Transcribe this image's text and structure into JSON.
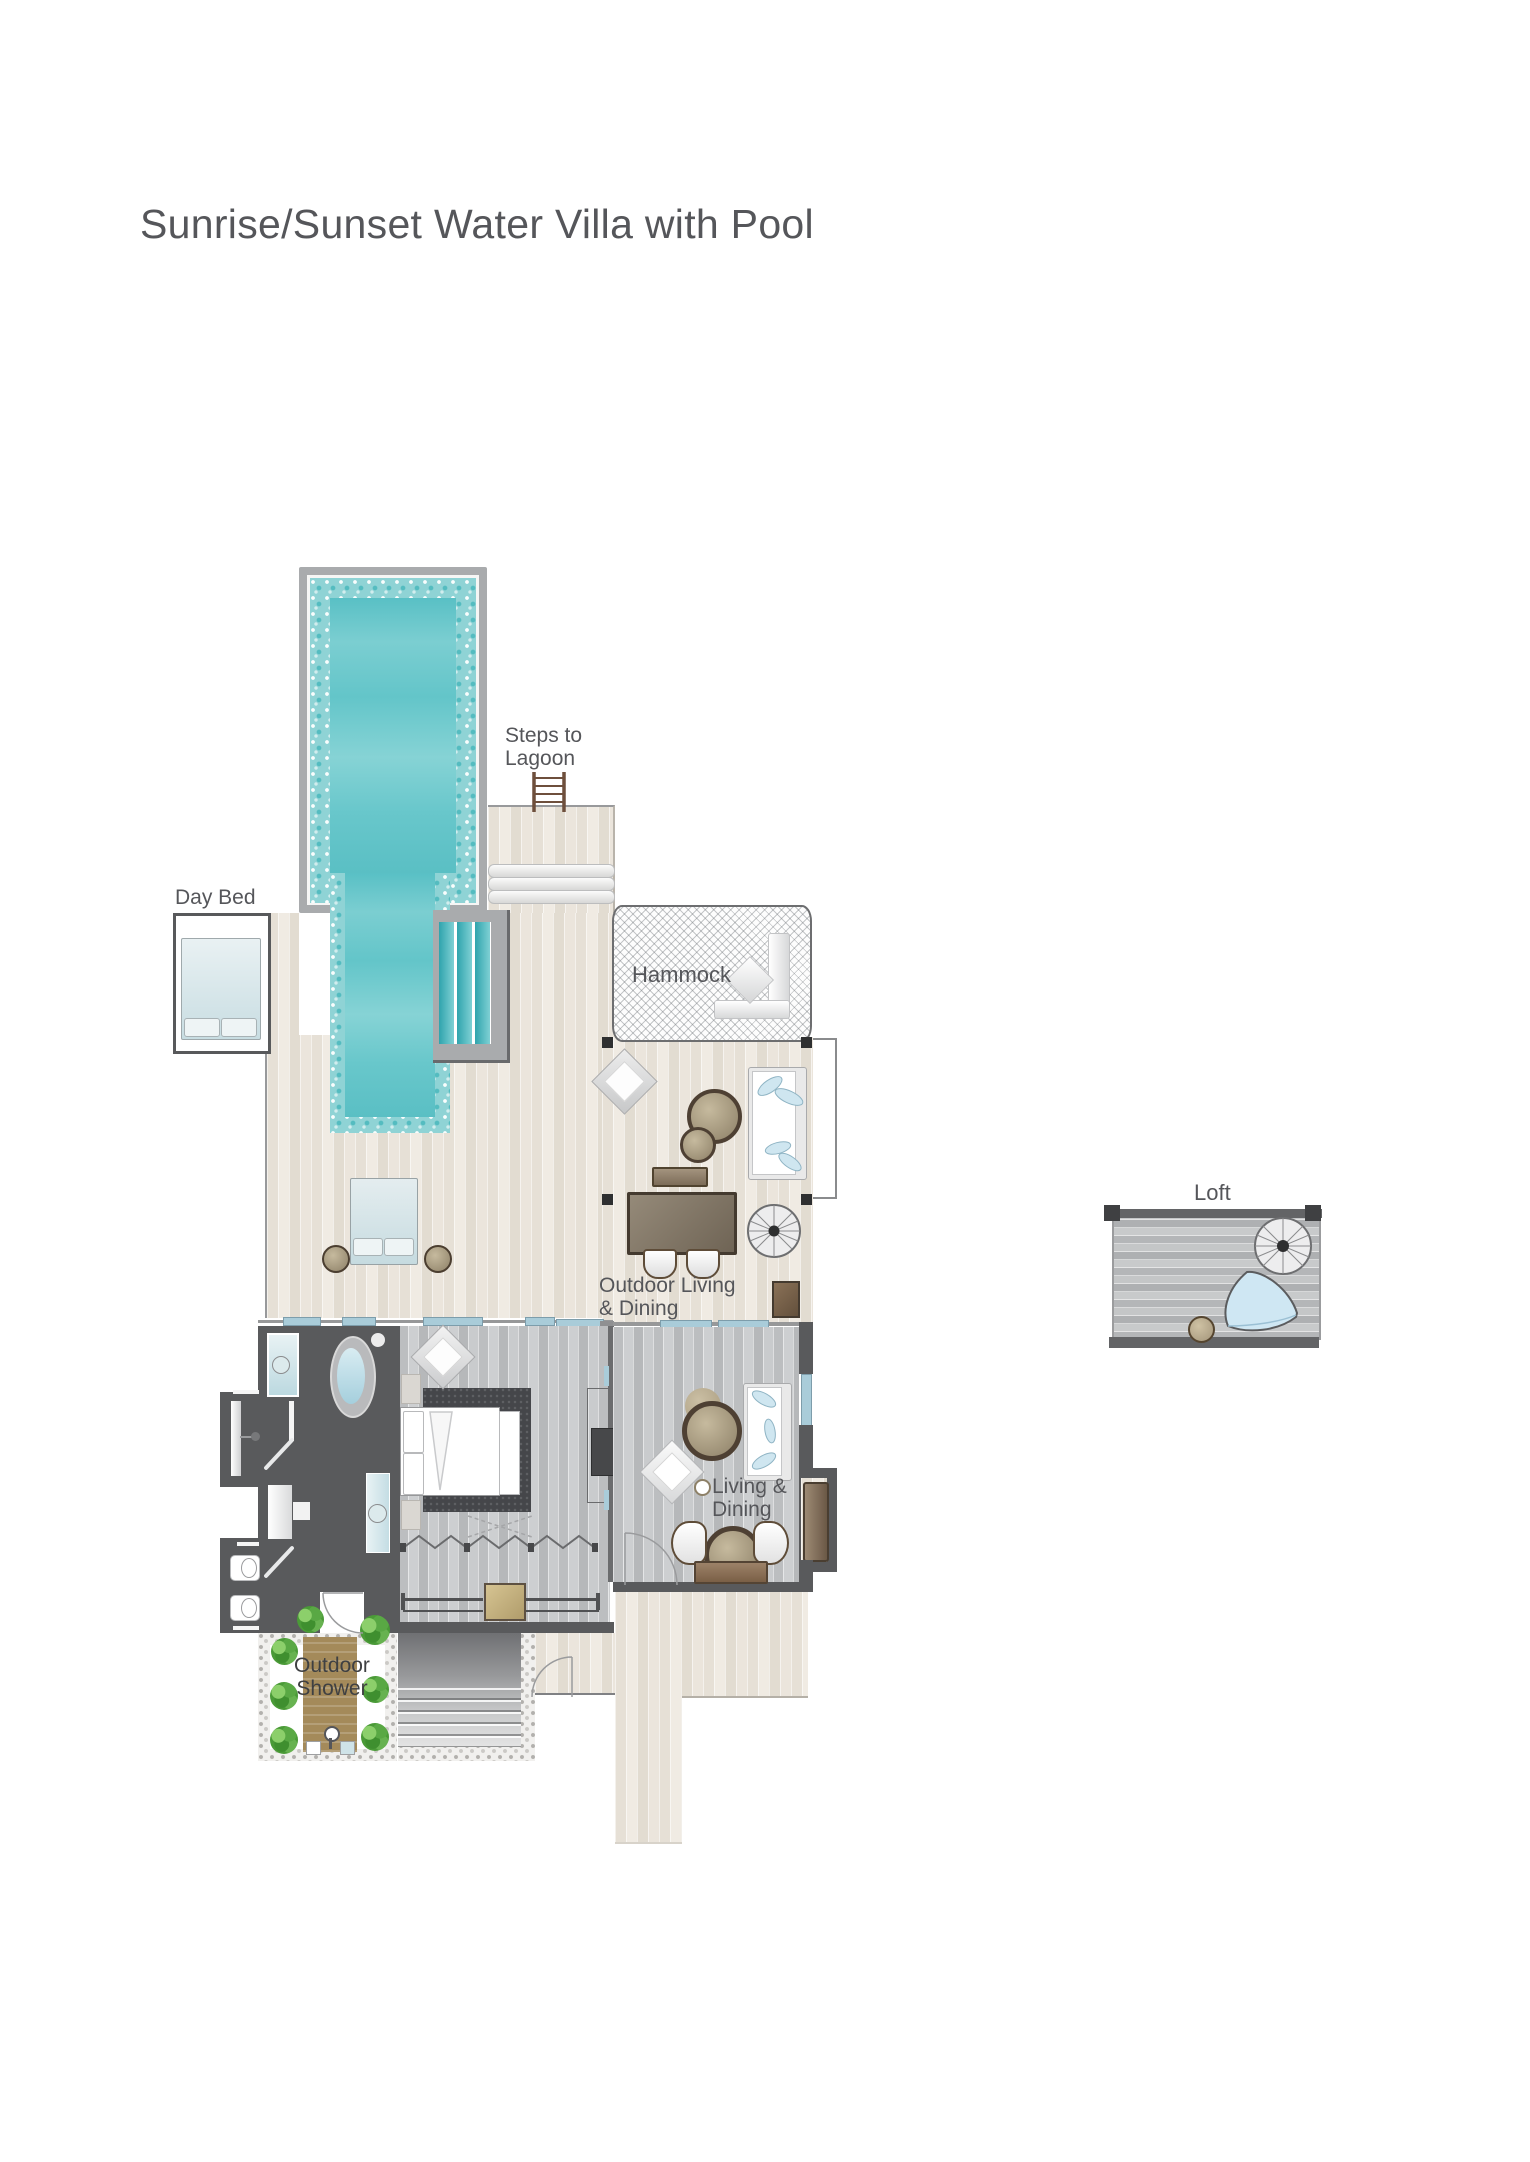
{
  "title": "Sunrise/Sunset Water Villa with Pool",
  "labels": {
    "day_bed": "Day Bed",
    "steps_to_lagoon_line1": "Steps to",
    "steps_to_lagoon_line2": "Lagoon",
    "hammock": "Hammock",
    "outdoor_living_line1": "Outdoor Living",
    "outdoor_living_line2": "& Dining",
    "living_dining_line1": "Living &",
    "living_dining_line2": "Dining",
    "loft": "Loft",
    "outdoor_shower_line1": "Outdoor",
    "outdoor_shower_line2": "Shower"
  },
  "colors": {
    "pool_water": "#62c4c8",
    "pool_mosaic": "#8fd3d5",
    "pool_frame": "#a9abad",
    "deck_wood_light": "#ece7df",
    "floor_gray": "#c6c8ca",
    "wall_dark": "#595a5c",
    "label_text": "#55565a",
    "window_accent_blue": "#a9ccd9",
    "furniture_wood_brown": "#8a7157",
    "table_tan": "#b5a88c",
    "plant_green": "#4a9a37",
    "shower_mat_brown": "#a48a5a",
    "bed_rug_charcoal": "#45464a"
  }
}
